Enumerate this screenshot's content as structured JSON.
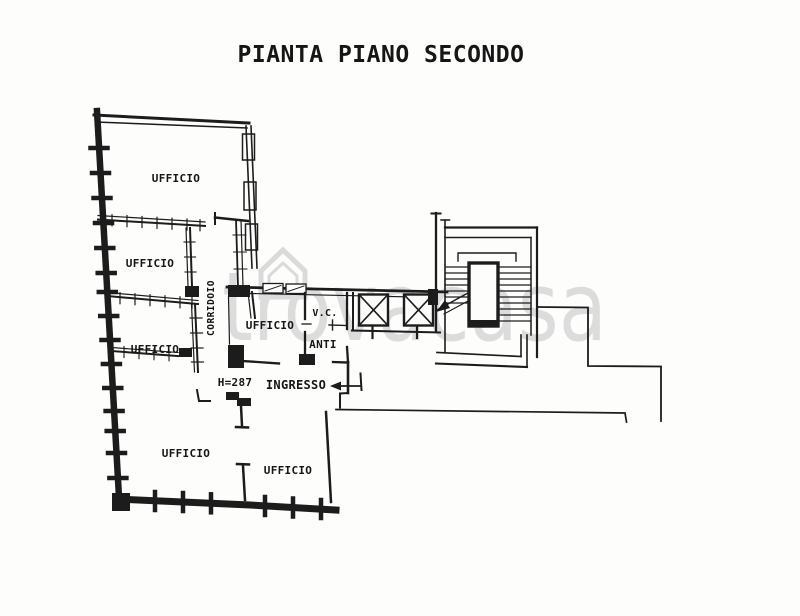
{
  "title": "PIANTA PIANO SECONDO",
  "watermark": {
    "text": "trovacasa"
  },
  "rooms": {
    "ufficio_top": "UFFICIO",
    "ufficio_second": "UFFICIO",
    "ufficio_third": "UFFICIO",
    "ufficio_bottom_left": "UFFICIO",
    "ufficio_bottom_center": "UFFICIO",
    "ufficio_center": "UFFICIO",
    "corridoio": "CORRIDOIO",
    "vc": "V.C.",
    "anti": "ANTI",
    "ingresso": "INGRESSO"
  },
  "annotations": {
    "height_note": "H=287"
  },
  "colors": {
    "ink": "#1c1c1c",
    "paper": "#fdfdfc",
    "watermark": "#dcdcdc"
  }
}
